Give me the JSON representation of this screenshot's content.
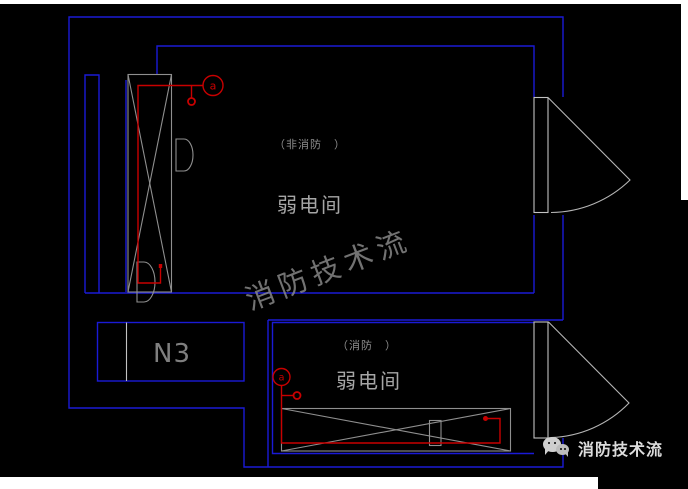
{
  "canvas": {
    "background": "#000000",
    "page_background": "#ffffff"
  },
  "colors": {
    "wall_blue": "#1a1ad6",
    "wiring_red": "#c80000",
    "cabinet_gray": "#8f8f8f",
    "door_gray": "#c2c2c2",
    "text_gray": "#a6a6a6",
    "brand_white": "#dcdcdc"
  },
  "drawing": {
    "upper_room": {
      "category_label": "（非消防　）",
      "room_label": "弱电间",
      "circuit_tag": "a"
    },
    "lower_room": {
      "category_label": "（消防　）",
      "room_label": "弱电间",
      "circuit_tag": "a"
    },
    "duct_box_label": "N3"
  },
  "watermark": {
    "text": "消防技术流"
  },
  "brand": {
    "wechat_name": "消防技术流",
    "logo": "wechat-icon"
  }
}
